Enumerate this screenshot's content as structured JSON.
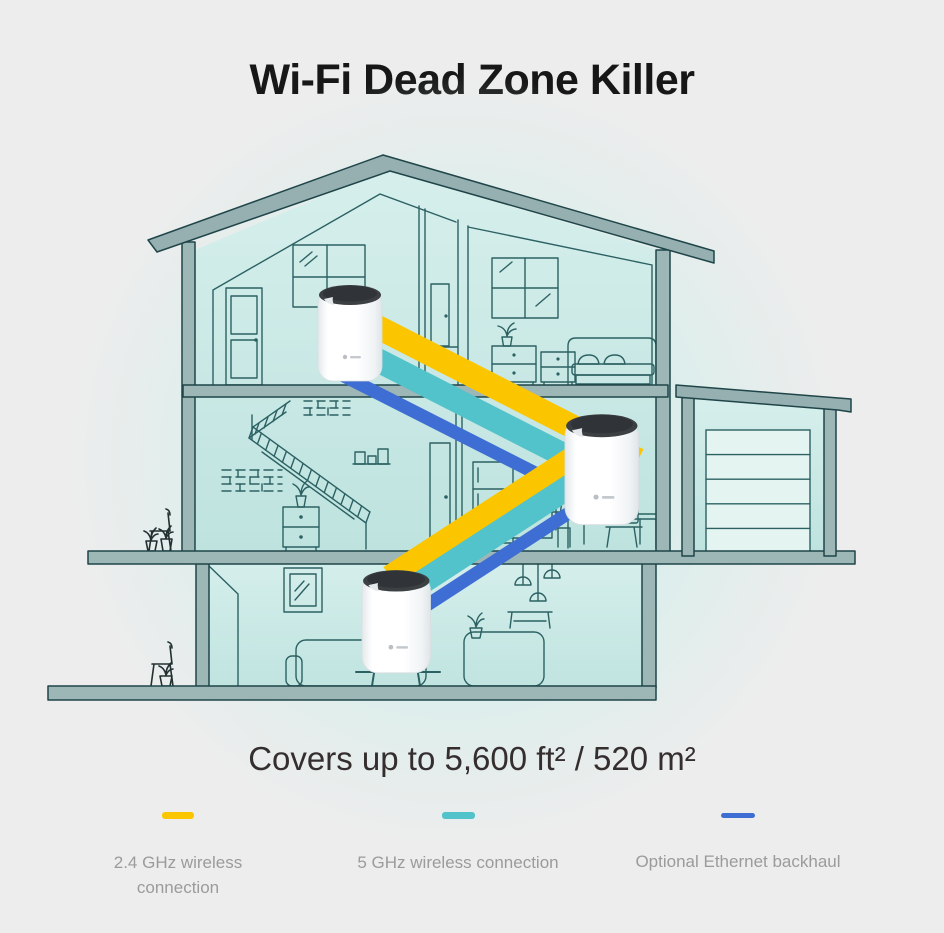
{
  "title": "Wi-Fi Dead Zone Killer",
  "coverage": "Covers up to 5,600 ft² / 520 m²",
  "legend": {
    "items": [
      {
        "label": "2.4 GHz wireless connection",
        "color": "#FBC600"
      },
      {
        "label": "5 GHz wireless connection",
        "color": "#52C2CB"
      },
      {
        "label": "Optional Ethernet backhaul",
        "color": "#3E6ED3"
      }
    ]
  },
  "diagram": {
    "deco_unit_count": 3,
    "house_accent": "#9db6b6",
    "room_fill_top": "#d6efec",
    "room_fill_bottom": "#bee3df"
  }
}
